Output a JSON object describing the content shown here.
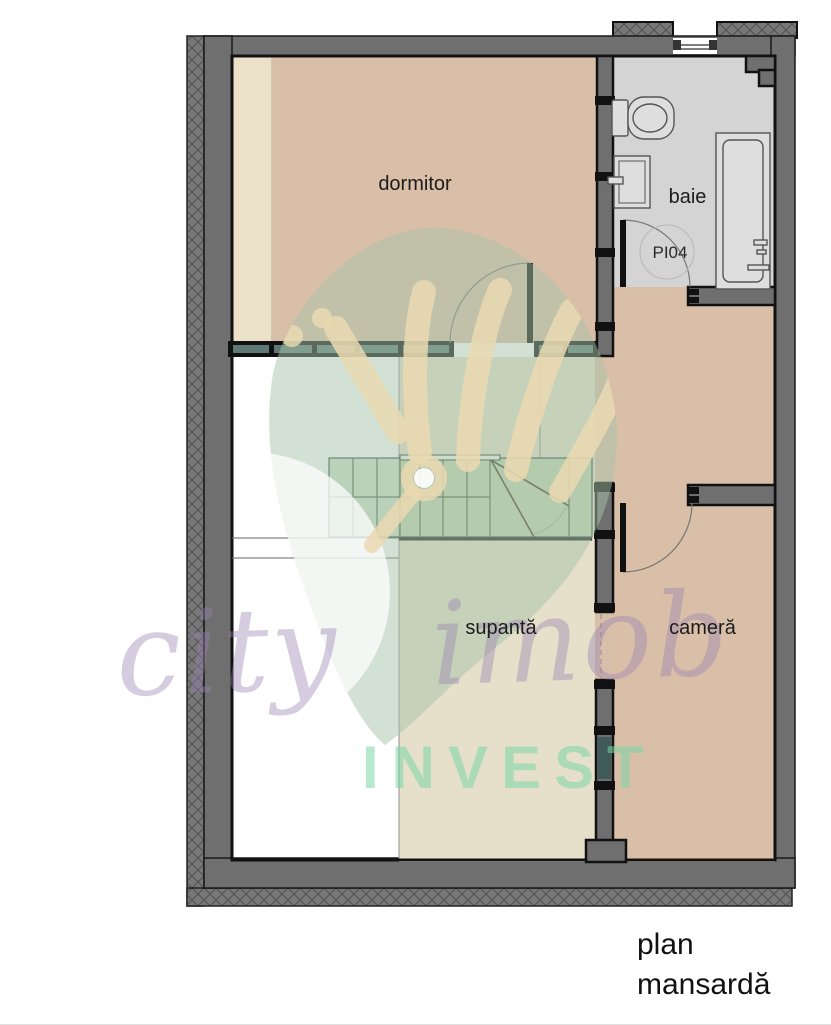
{
  "plan": {
    "rooms": {
      "dormitor": "dormitor",
      "baie": "baie",
      "supanta": "supantă",
      "camera": "cameră"
    },
    "door_label": "PI04",
    "caption": {
      "line1": "plan",
      "line2": "mansardă"
    }
  },
  "watermark": {
    "script": "city imob",
    "invest": "INVEST"
  },
  "colors": {
    "wall_gray": "#6f6f6f",
    "outline_black": "#111111",
    "dormitor_fill": "#dabfa8",
    "dormitor_strip": "#eae1c8",
    "baie_fill": "#d4d4d4",
    "camera_fill": "#dabfa8",
    "supanta_fill": "#e6dfca",
    "stairs_fill": "#a7c6a0",
    "glass_segment": "#5e7876",
    "watermark_leaf": "#a6c4a8",
    "watermark_hand": "#ead9b2",
    "watermark_script": "#967fb2",
    "watermark_invest": "#7ad7a6"
  }
}
